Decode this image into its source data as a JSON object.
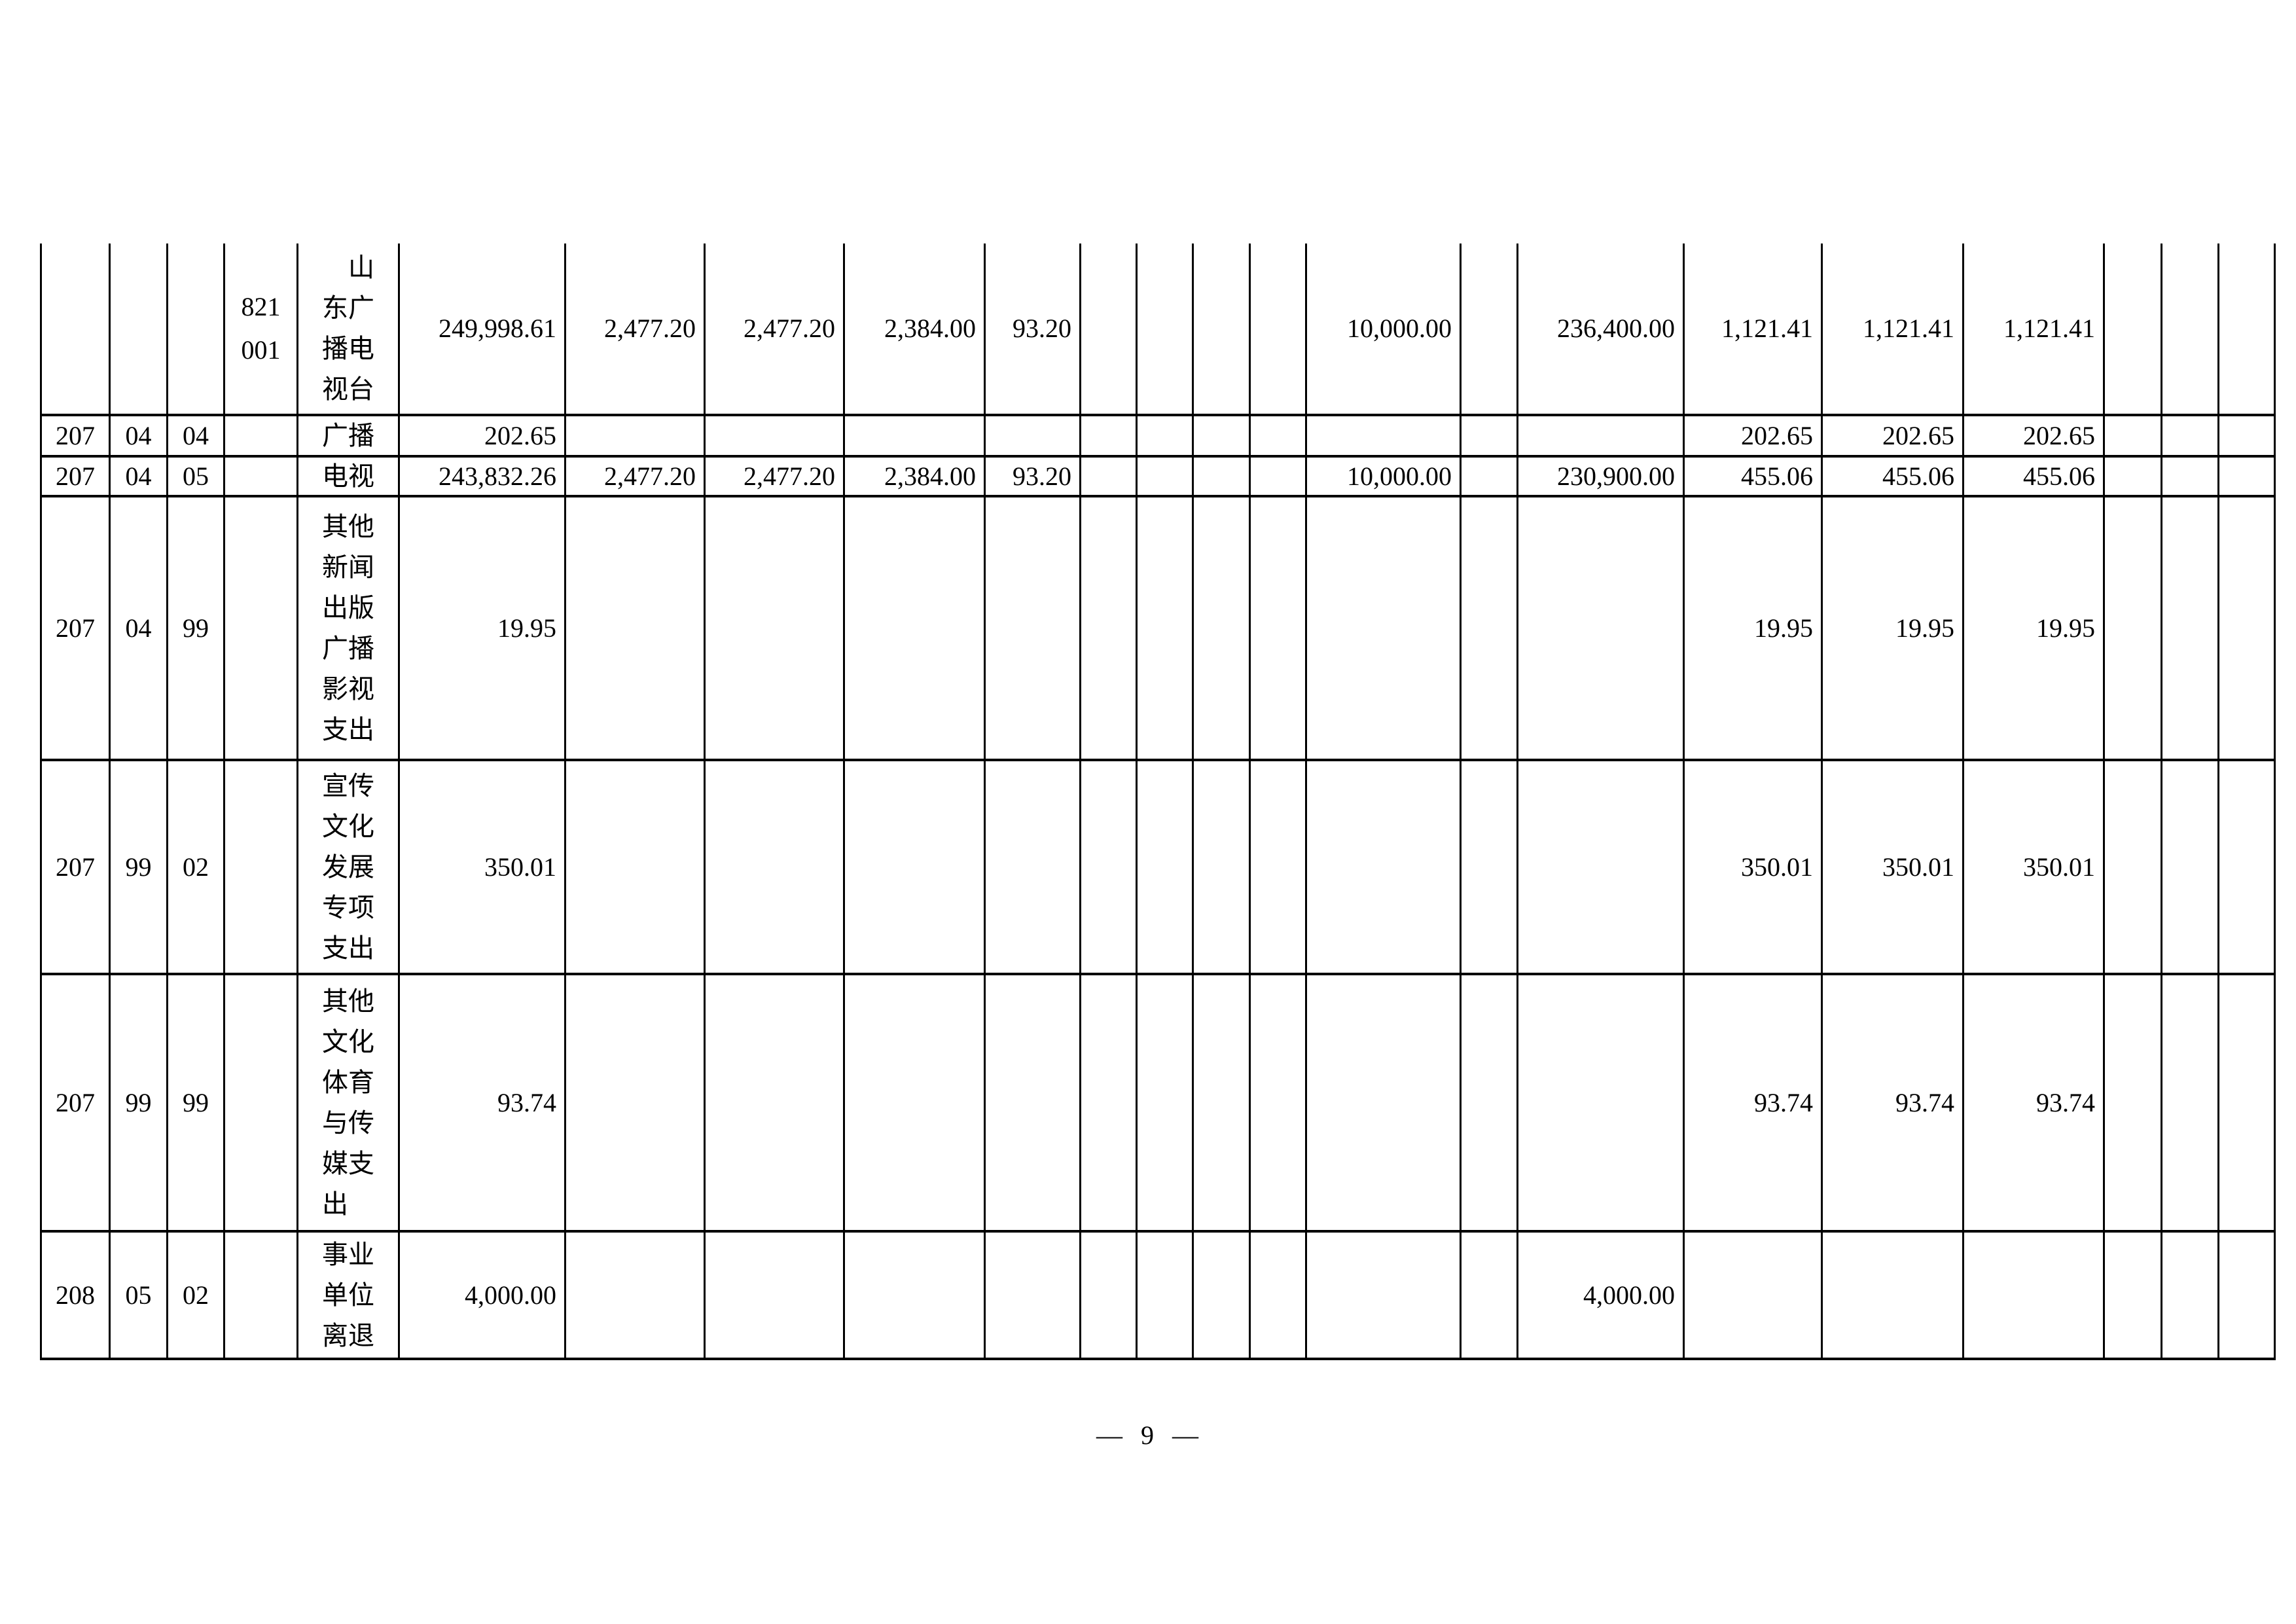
{
  "page": {
    "footer_page_number": "— 9 —"
  },
  "unit": {
    "code": "821 001",
    "name": "山东广播电视台"
  },
  "table": {
    "rows": [
      {
        "cells": [
          "",
          "",
          "",
          "821\n001",
          "　山\n东广\n播电\n视台",
          "249,998.61",
          "2,477.20",
          "2,477.20",
          "2,384.00",
          "93.20",
          "",
          "",
          "",
          "",
          "10,000.00",
          "",
          "236,400.00",
          "1,121.41",
          "1,121.41",
          "1,121.41",
          "",
          "",
          ""
        ]
      },
      {
        "cells": [
          "207",
          "04",
          "04",
          "",
          "广播",
          "202.65",
          "",
          "",
          "",
          "",
          "",
          "",
          "",
          "",
          "",
          "",
          "",
          "202.65",
          "202.65",
          "202.65",
          "",
          "",
          ""
        ]
      },
      {
        "cells": [
          "207",
          "04",
          "05",
          "",
          "电视",
          "243,832.26",
          "2,477.20",
          "2,477.20",
          "2,384.00",
          "93.20",
          "",
          "",
          "",
          "",
          "10,000.00",
          "",
          "230,900.00",
          "455.06",
          "455.06",
          "455.06",
          "",
          "",
          ""
        ]
      },
      {
        "cells": [
          "207",
          "04",
          "99",
          "",
          "其他\n新闻\n出版\n广播\n影视\n支出",
          "19.95",
          "",
          "",
          "",
          "",
          "",
          "",
          "",
          "",
          "",
          "",
          "",
          "19.95",
          "19.95",
          "19.95",
          "",
          "",
          ""
        ]
      },
      {
        "cells": [
          "207",
          "99",
          "02",
          "",
          "宣传\n文化\n发展\n专项\n支出",
          "350.01",
          "",
          "",
          "",
          "",
          "",
          "",
          "",
          "",
          "",
          "",
          "",
          "350.01",
          "350.01",
          "350.01",
          "",
          "",
          ""
        ]
      },
      {
        "cells": [
          "207",
          "99",
          "99",
          "",
          "其他\n文化\n体育\n与传\n媒支\n出",
          "93.74",
          "",
          "",
          "",
          "",
          "",
          "",
          "",
          "",
          "",
          "",
          "",
          "93.74",
          "93.74",
          "93.74",
          "",
          "",
          ""
        ]
      },
      {
        "cells": [
          "208",
          "05",
          "02",
          "",
          "事业\n单位\n离退",
          "4,000.00",
          "",
          "",
          "",
          "",
          "",
          "",
          "",
          "",
          "",
          "",
          "4,000.00",
          "",
          "",
          "",
          "",
          "",
          ""
        ]
      }
    ]
  }
}
